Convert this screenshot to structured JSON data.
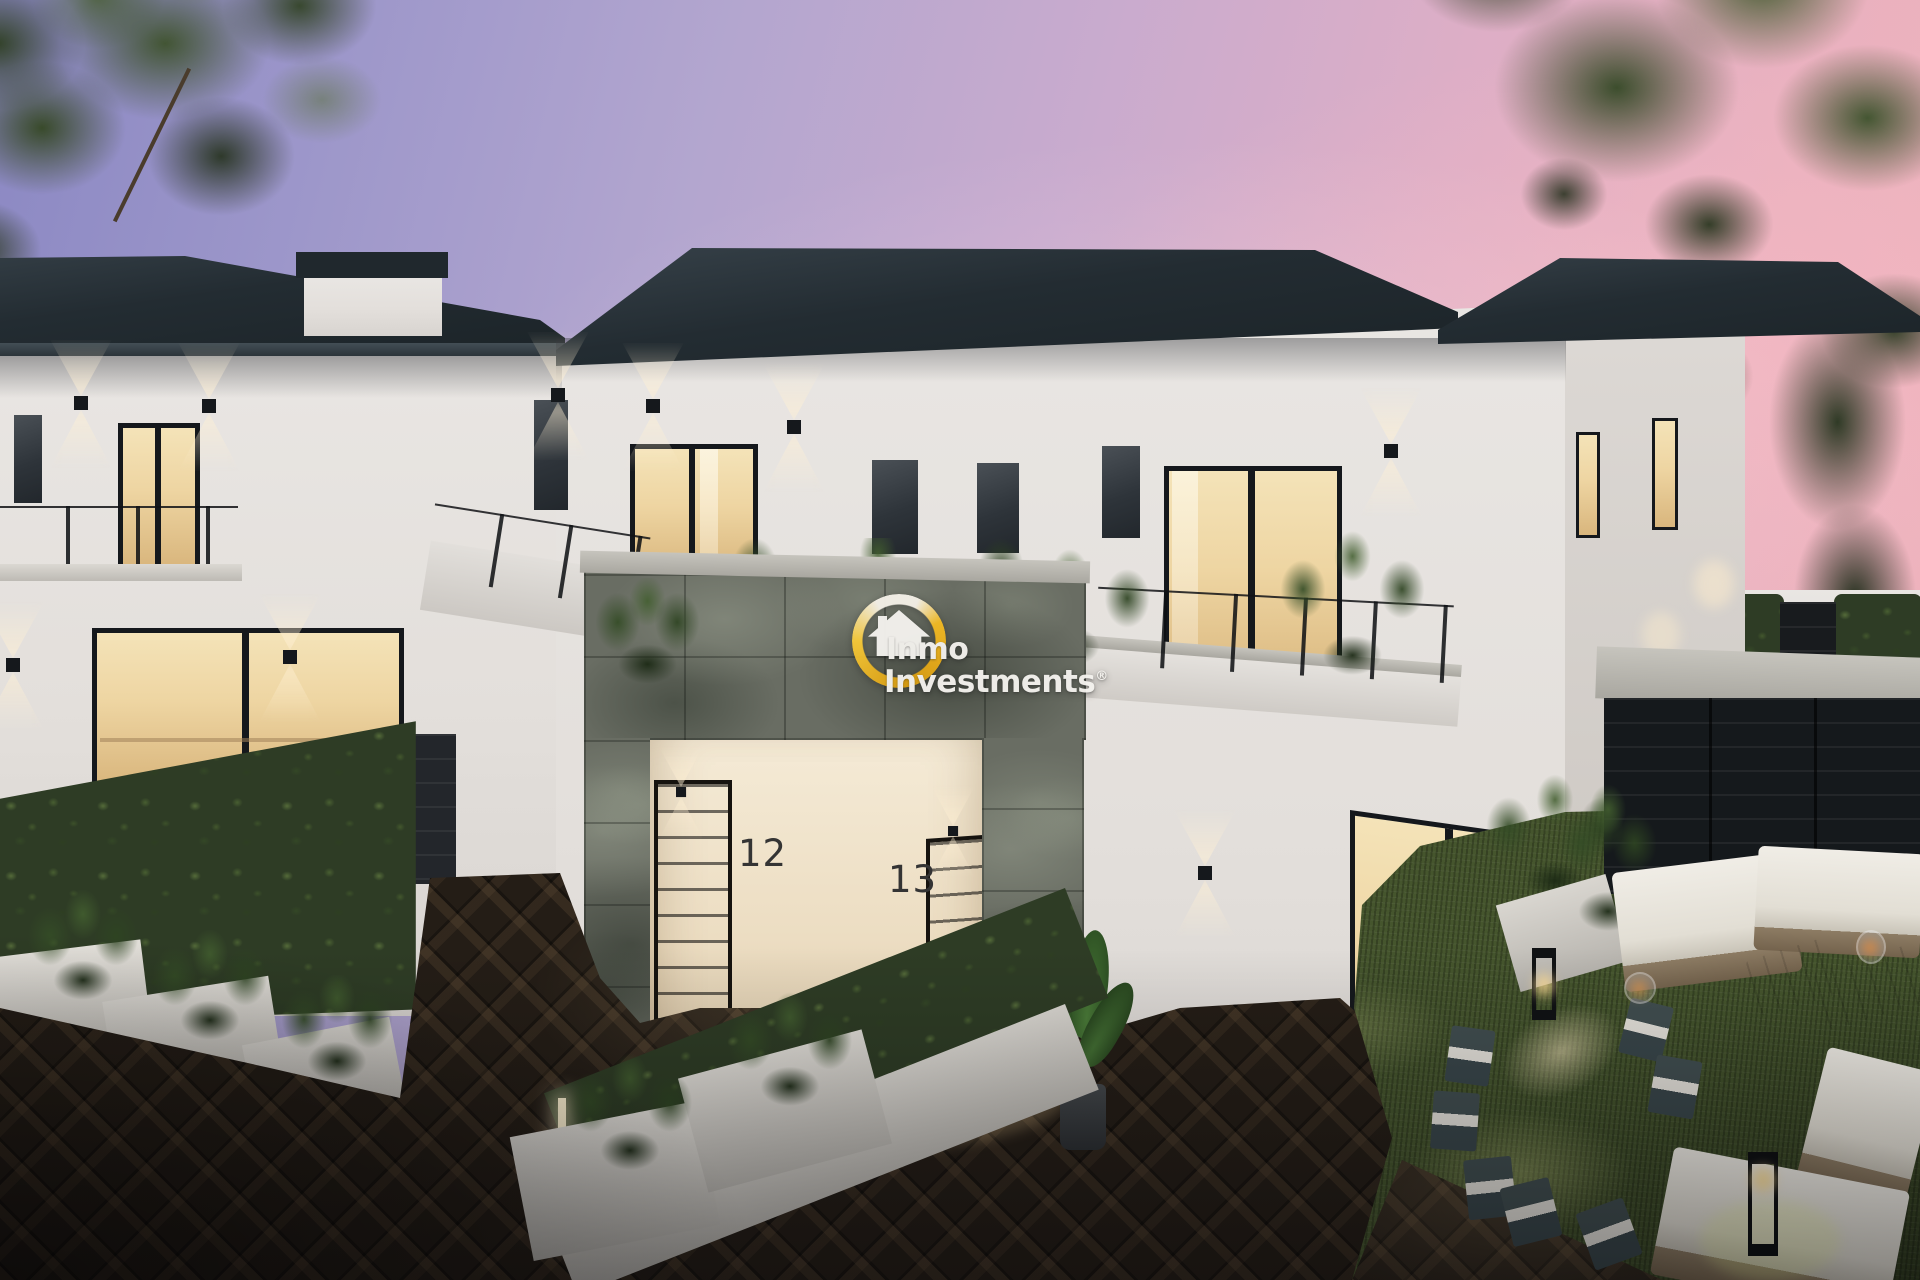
{
  "image_type": "architectural-dusk-render",
  "watermark": {
    "brand_line1": "Inmo",
    "brand_line2": "Investments",
    "registered_mark": "®"
  },
  "house_numbers": {
    "door_left": "12",
    "door_right": "13"
  },
  "palette": {
    "sky1": "#8b88c3",
    "sky2": "#c9abce",
    "sky3": "#f0b3bb",
    "roof": "#232c32",
    "roofhl": "#39444c",
    "wall": "#e9e6e3",
    "wallsh": "#d8d4d0",
    "warm": "#eed5a2",
    "warm2": "#d9b67d",
    "stone": "#696d63",
    "hedge": "#2e3c25",
    "hedgehl": "#5f7b41",
    "grass": "#45552d",
    "paving": "#241d16",
    "wood": "#a18a69",
    "gold": "#efb420",
    "ink": "#15181c",
    "num": "#343434",
    "white": "#f4f2ee"
  }
}
